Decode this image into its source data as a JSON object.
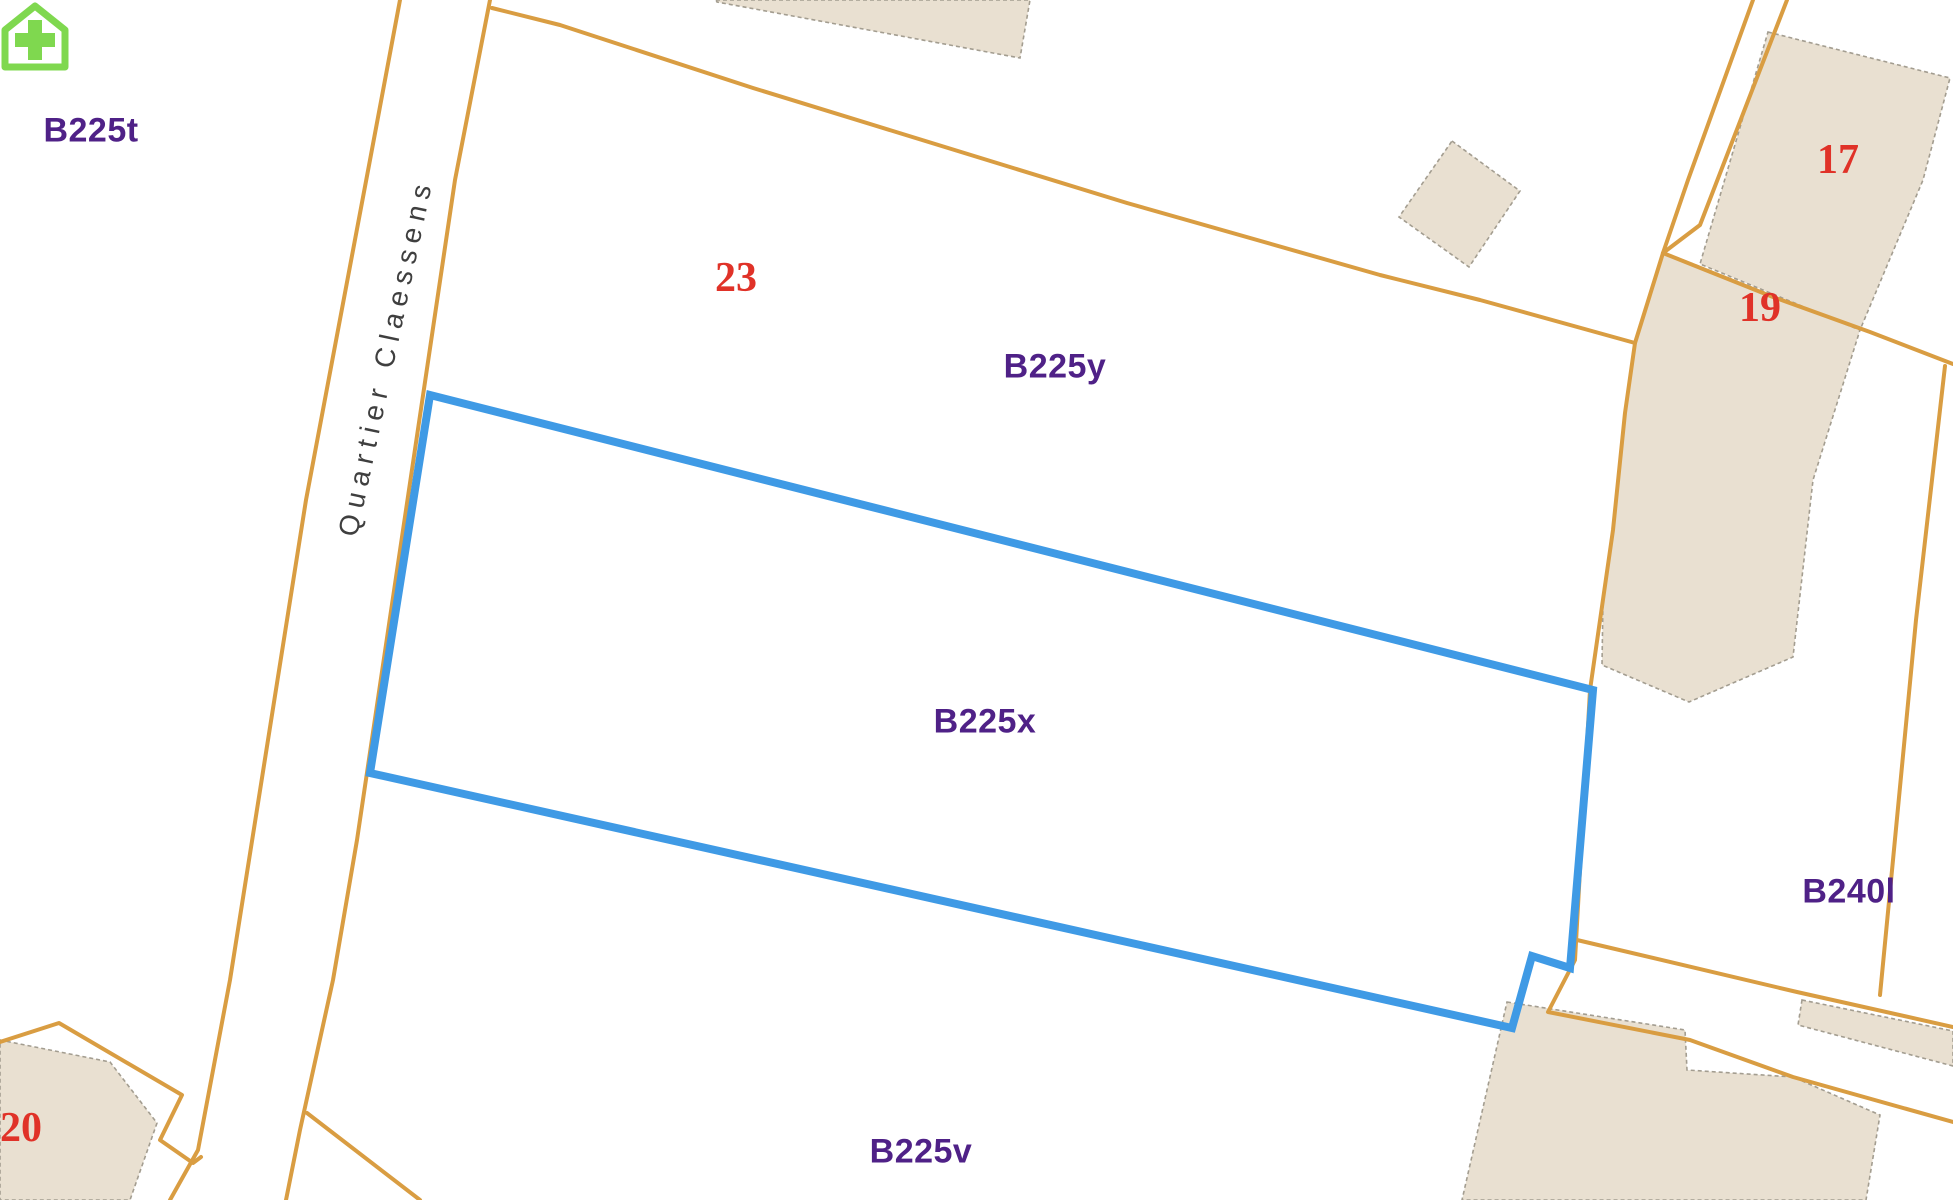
{
  "map": {
    "street": {
      "name": "Quartier Claessens"
    },
    "selected_parcel": {
      "id": "B225x"
    },
    "labels": {
      "b225t": "B225t",
      "b225y": "B225y",
      "b225x": "B225x",
      "b225v": "B225v",
      "b240l": "B240l"
    },
    "house_numbers": {
      "n17": "17",
      "n19": "19",
      "n20": "20",
      "n23": "23"
    },
    "poi": {
      "icon": "house-plus-icon"
    },
    "colors": {
      "parcel_boundary": "#D99D42",
      "selection_outline": "#3F9AE5",
      "building_fill": "#E9E0D1",
      "building_border": "#A39D90",
      "parcel_label_text": "#4F2187",
      "house_number_text": "#E03228",
      "poi_green": "#7FD84F",
      "street_text": "#3F3F3F"
    }
  }
}
